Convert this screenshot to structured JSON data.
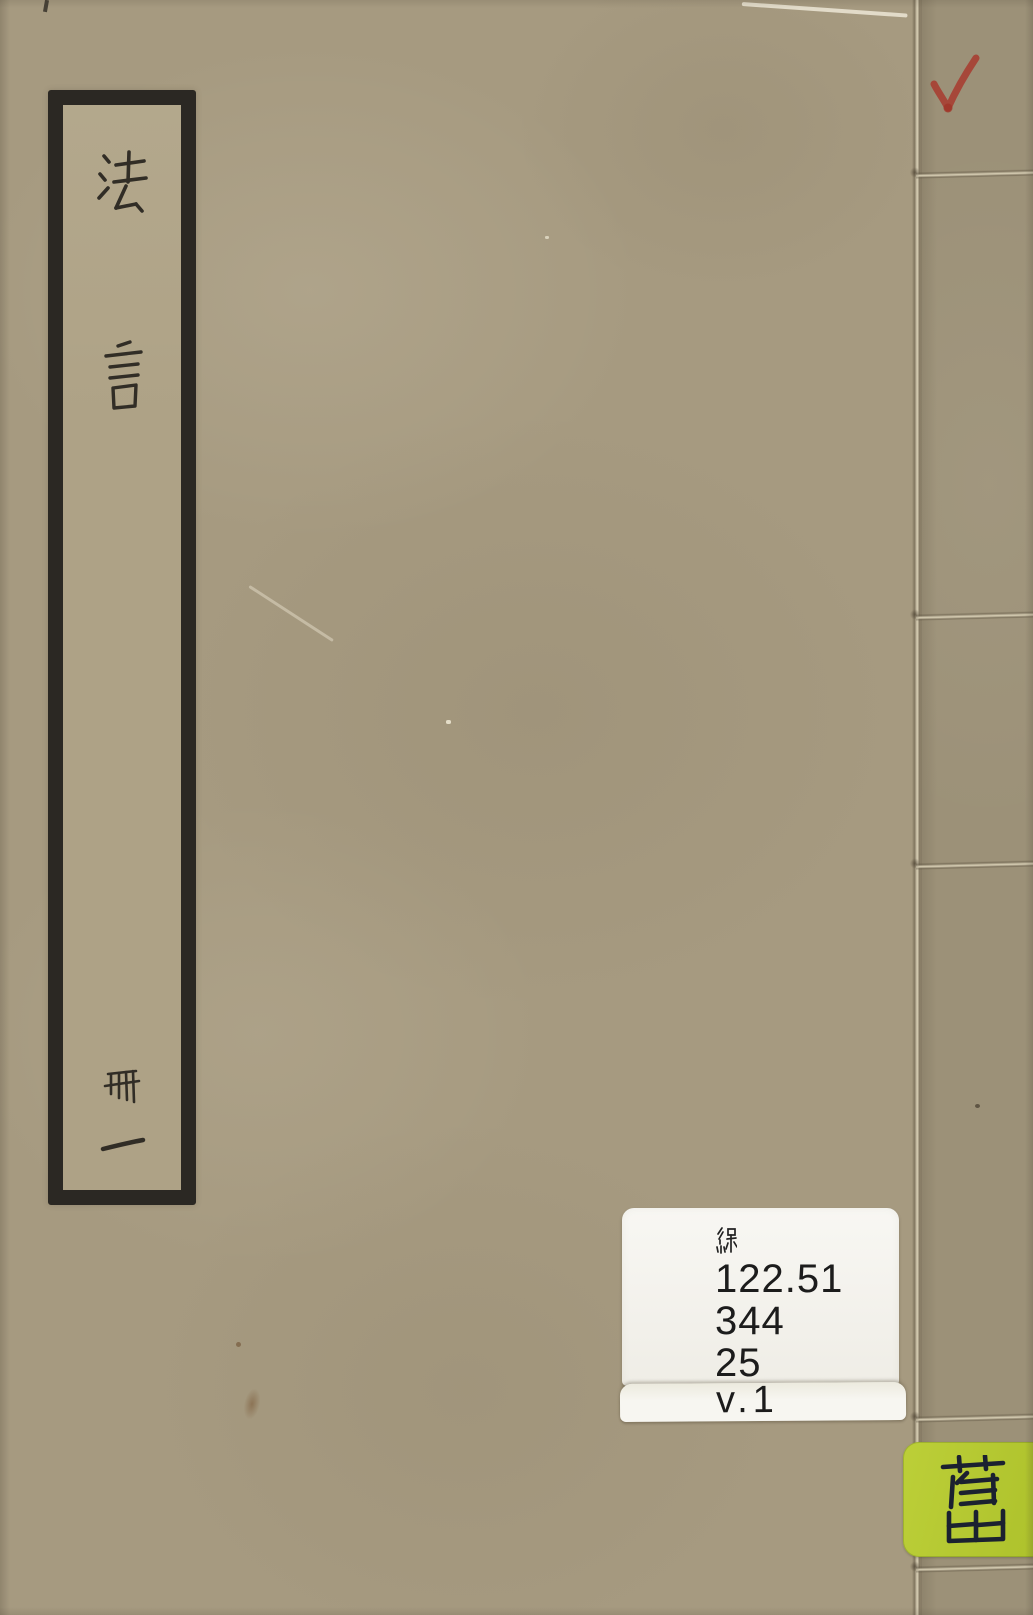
{
  "scan": {
    "title_label": {
      "title": "法言",
      "chars": [
        "法",
        "言"
      ],
      "volume": "冊一",
      "volume_chars": [
        "冊",
        "一"
      ]
    },
    "call_number_sticker": {
      "script_char": "線",
      "lines": [
        "122.51",
        "344",
        "25"
      ],
      "volume_line": "v.1"
    },
    "category_sticker": {
      "char": "舊"
    },
    "red_checkmark": "✓",
    "colors": {
      "cover": "#a69a80",
      "spine": "#9c9178",
      "label_bg": "#aea286",
      "label_border_ink": "#2b2823",
      "character_ink": "#312d26",
      "sticker_bg": "#f5f3ee",
      "sticker_text": "#1c1c1c",
      "category_bg": "#b5c832",
      "category_ink": "#1b2130",
      "checkmark_red": "#a83a2e",
      "thread": "#dbd2b8"
    }
  }
}
